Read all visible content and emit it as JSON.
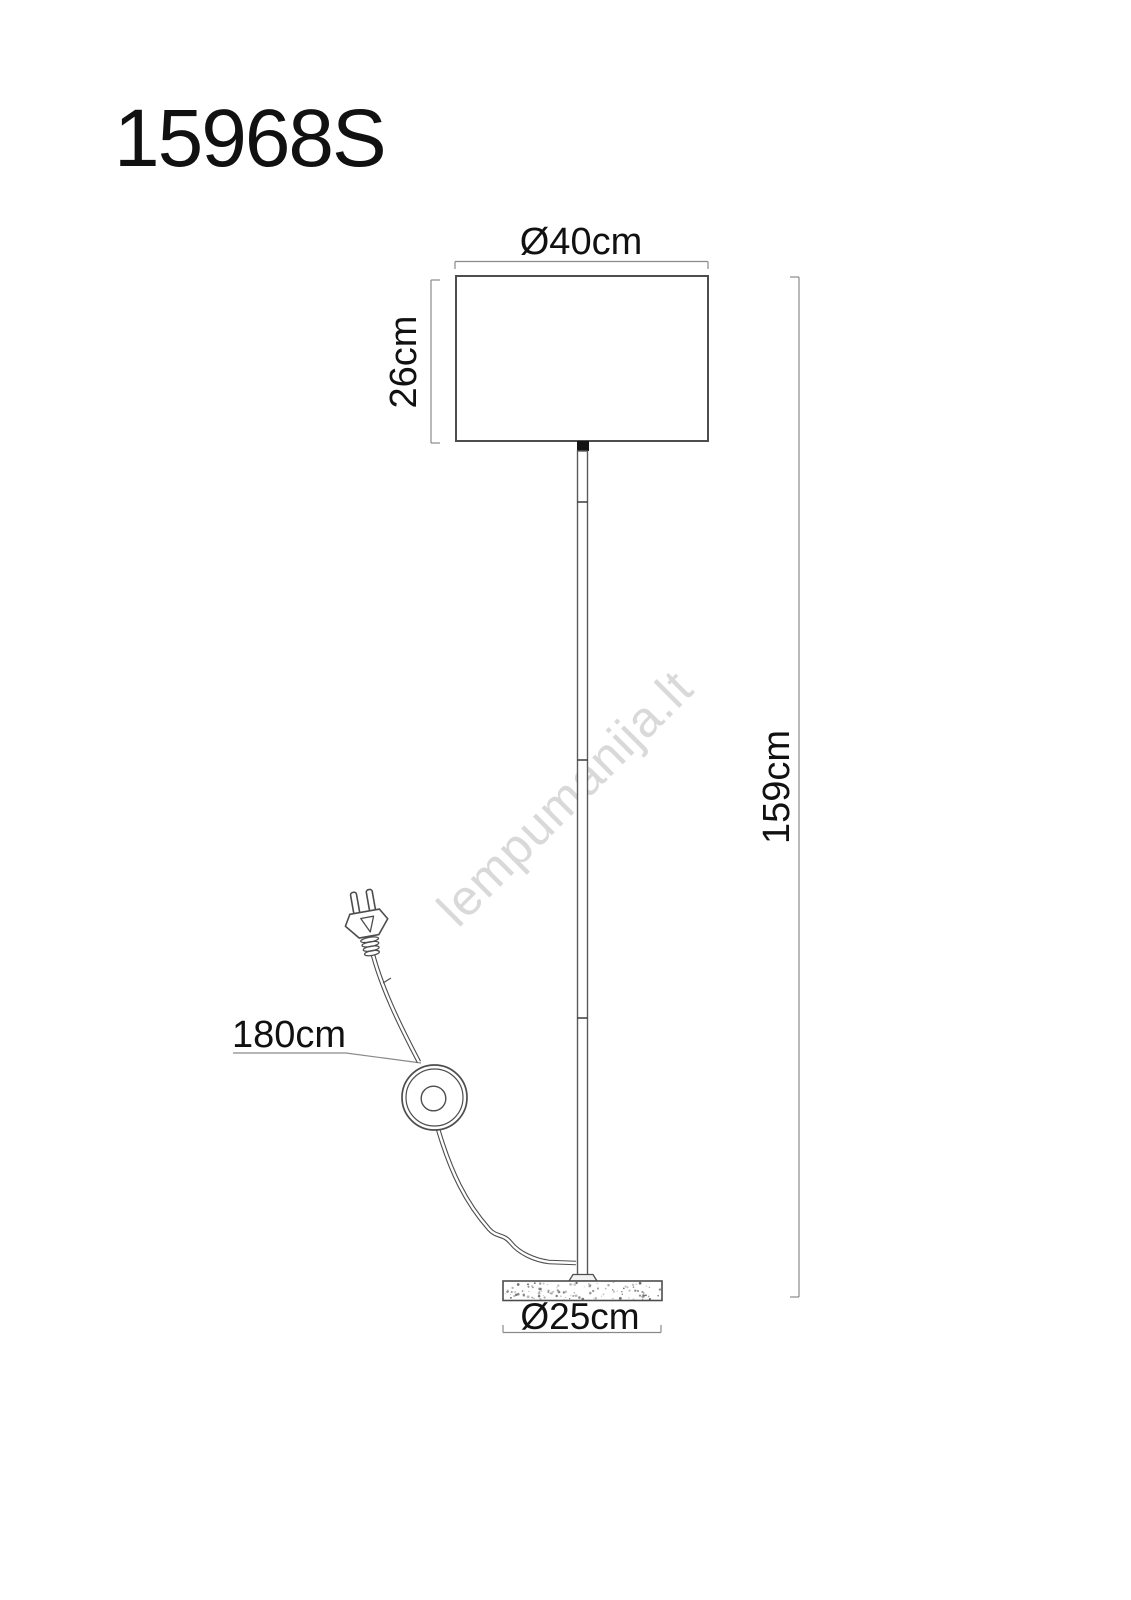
{
  "product": {
    "code": "15968S"
  },
  "watermark": {
    "text": "lempumanija.lt",
    "color": "#d9d9d9"
  },
  "dimensions": {
    "shade_diameter": {
      "label": "Ø40cm"
    },
    "shade_height": {
      "label": "26cm"
    },
    "total_height": {
      "label": "159cm"
    },
    "cable_length": {
      "label": "180cm"
    },
    "base_diameter": {
      "label": "Ø25cm"
    }
  },
  "colors": {
    "background": "#ffffff",
    "outline": "#4d4d4d",
    "dimension_line": "#8a8a8a",
    "text": "#111111",
    "socket": "#141414",
    "watermark": "#d9d9d9"
  }
}
